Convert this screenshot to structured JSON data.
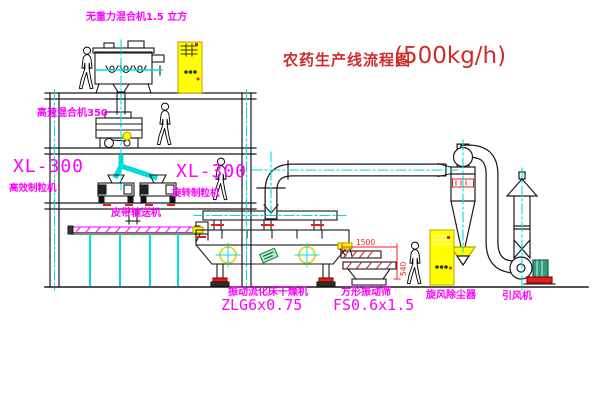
{
  "diagram": {
    "title": {
      "name": "农药生产线流程图",
      "capacity": "(500kg/h)"
    },
    "equipment_labels": {
      "gravity_mixer": "无重力混合机1.5 立方",
      "high_speed_mixer": "高速混合机350",
      "granulator_left_model": "XL-300",
      "granulator_left_name": "高效制粒机",
      "granulator_mid_model": "XL-300",
      "granulator_mid_name": "旋转制粒机",
      "belt_conveyor": "皮带输送机",
      "fluid_bed_dryer": "振动流化床干燥机",
      "fluid_bed_dryer_model": "ZLG6x0.75",
      "vibrating_screen": "方形振动筛",
      "vibrating_screen_model": "FS0.6x1.5",
      "cyclone": "旋风除尘器",
      "induced_draft_fan": "引风机"
    },
    "dimensions": {
      "screen_length": "1500",
      "screen_height": "540"
    },
    "colors": {
      "label_magenta": "#ff00ff",
      "title_red": "#cf2b2b",
      "highlight_yellow": "#ffff00",
      "centerline_cyan": "#00dcdc",
      "detail_red": "#e02020",
      "belt_green": "#00a000",
      "motor_teal": "#2e9e7e"
    }
  }
}
